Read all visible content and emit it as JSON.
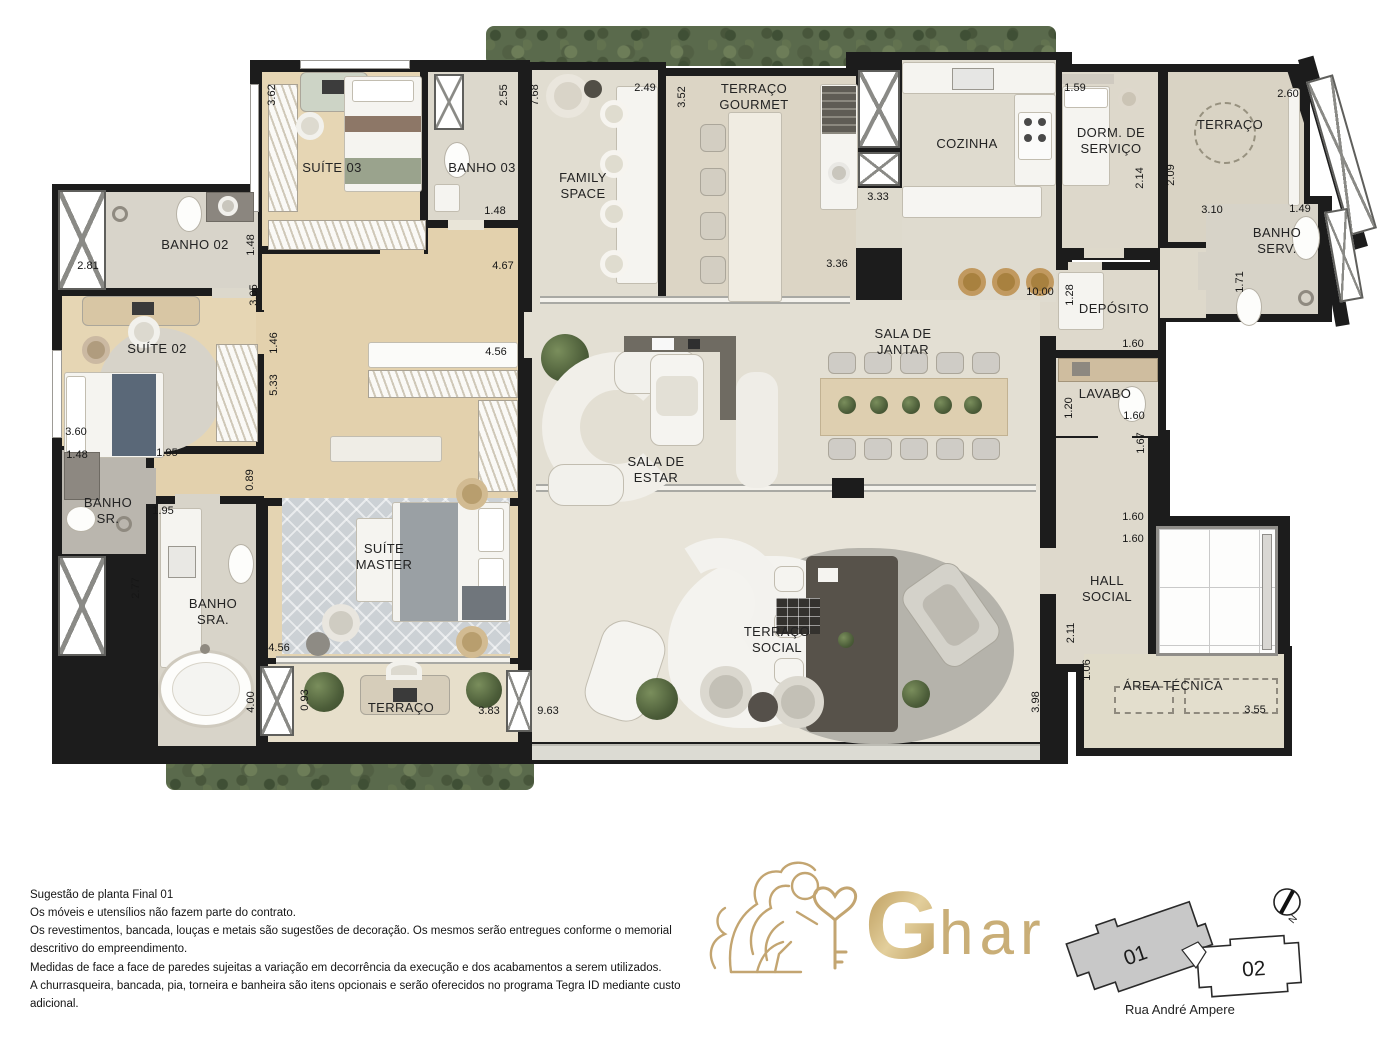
{
  "title": "Sugestão de planta Final 01",
  "rooms": [
    "SUÍTE 03",
    "BANHO 03",
    "BANHO 02",
    "SUÍTE 02",
    "FAMILY SPACE",
    "TERRAÇO GOURMET",
    "COZINHA",
    "DORM. DE SERVIÇO",
    "TERRAÇO",
    "BANHO SERV.",
    "DEPÓSITO",
    "SALA DE JANTAR",
    "LAVABO",
    "SALA DE ESTAR",
    "SUÍTE MASTER",
    "BANHO SR.",
    "BANHO SRA.",
    "TERRAÇO",
    "TERRAÇO SOCIAL",
    "HALL SOCIAL",
    "ÁREA TÉCNICA"
  ],
  "dims": [
    "3.62",
    "2.55",
    "7.68",
    "2.49",
    "3.52",
    "1.59",
    "2.60",
    "1.48",
    "2.81",
    "1.48",
    "3.05",
    "4.67",
    "3.33",
    "3.36",
    "2.14",
    "2.09",
    "3.10",
    "1.49",
    "1.71",
    "10.00",
    "1.28",
    "1.60",
    "1.46",
    "4.56",
    "5.33",
    "1.20",
    "1.60",
    "1.67",
    "3.60",
    "1.48",
    "1.95",
    "0.89",
    "1.95",
    "2.77",
    "4.56",
    "4.00",
    "0.93",
    "3.83",
    "9.63",
    "3.98",
    "2.11",
    "1.06",
    "1.60",
    "1.60",
    "3.55"
  ],
  "footer": {
    "lines": [
      "Sugestão de planta Final 01",
      "Os móveis e utensílios não fazem parte do contrato.",
      "Os revestimentos, bancada, louças e metais são sugestões de decoração. Os mesmos serão entregues conforme o memorial descritivo do empreendimento.",
      "Medidas de face a face de paredes sujeitas a variação em decorrência da execução e dos acabamentos a serem utilizados.",
      "A churrasqueira, bancada, pia, torneira e banheira são itens opcionais e serão oferecidos no programa Tegra ID mediante custo adicional."
    ]
  },
  "brand": {
    "initial": "G",
    "rest": "har"
  },
  "keyplan": {
    "unit1": "01",
    "unit2": "02",
    "compass": "N",
    "street": "Rua André Ampere"
  },
  "colors": {
    "gold": "#c3a571",
    "wall": "#1c1c1c",
    "wood": "#e5d4b2",
    "tile": "#e1ddd1",
    "greenery": "#5a6a4c"
  }
}
